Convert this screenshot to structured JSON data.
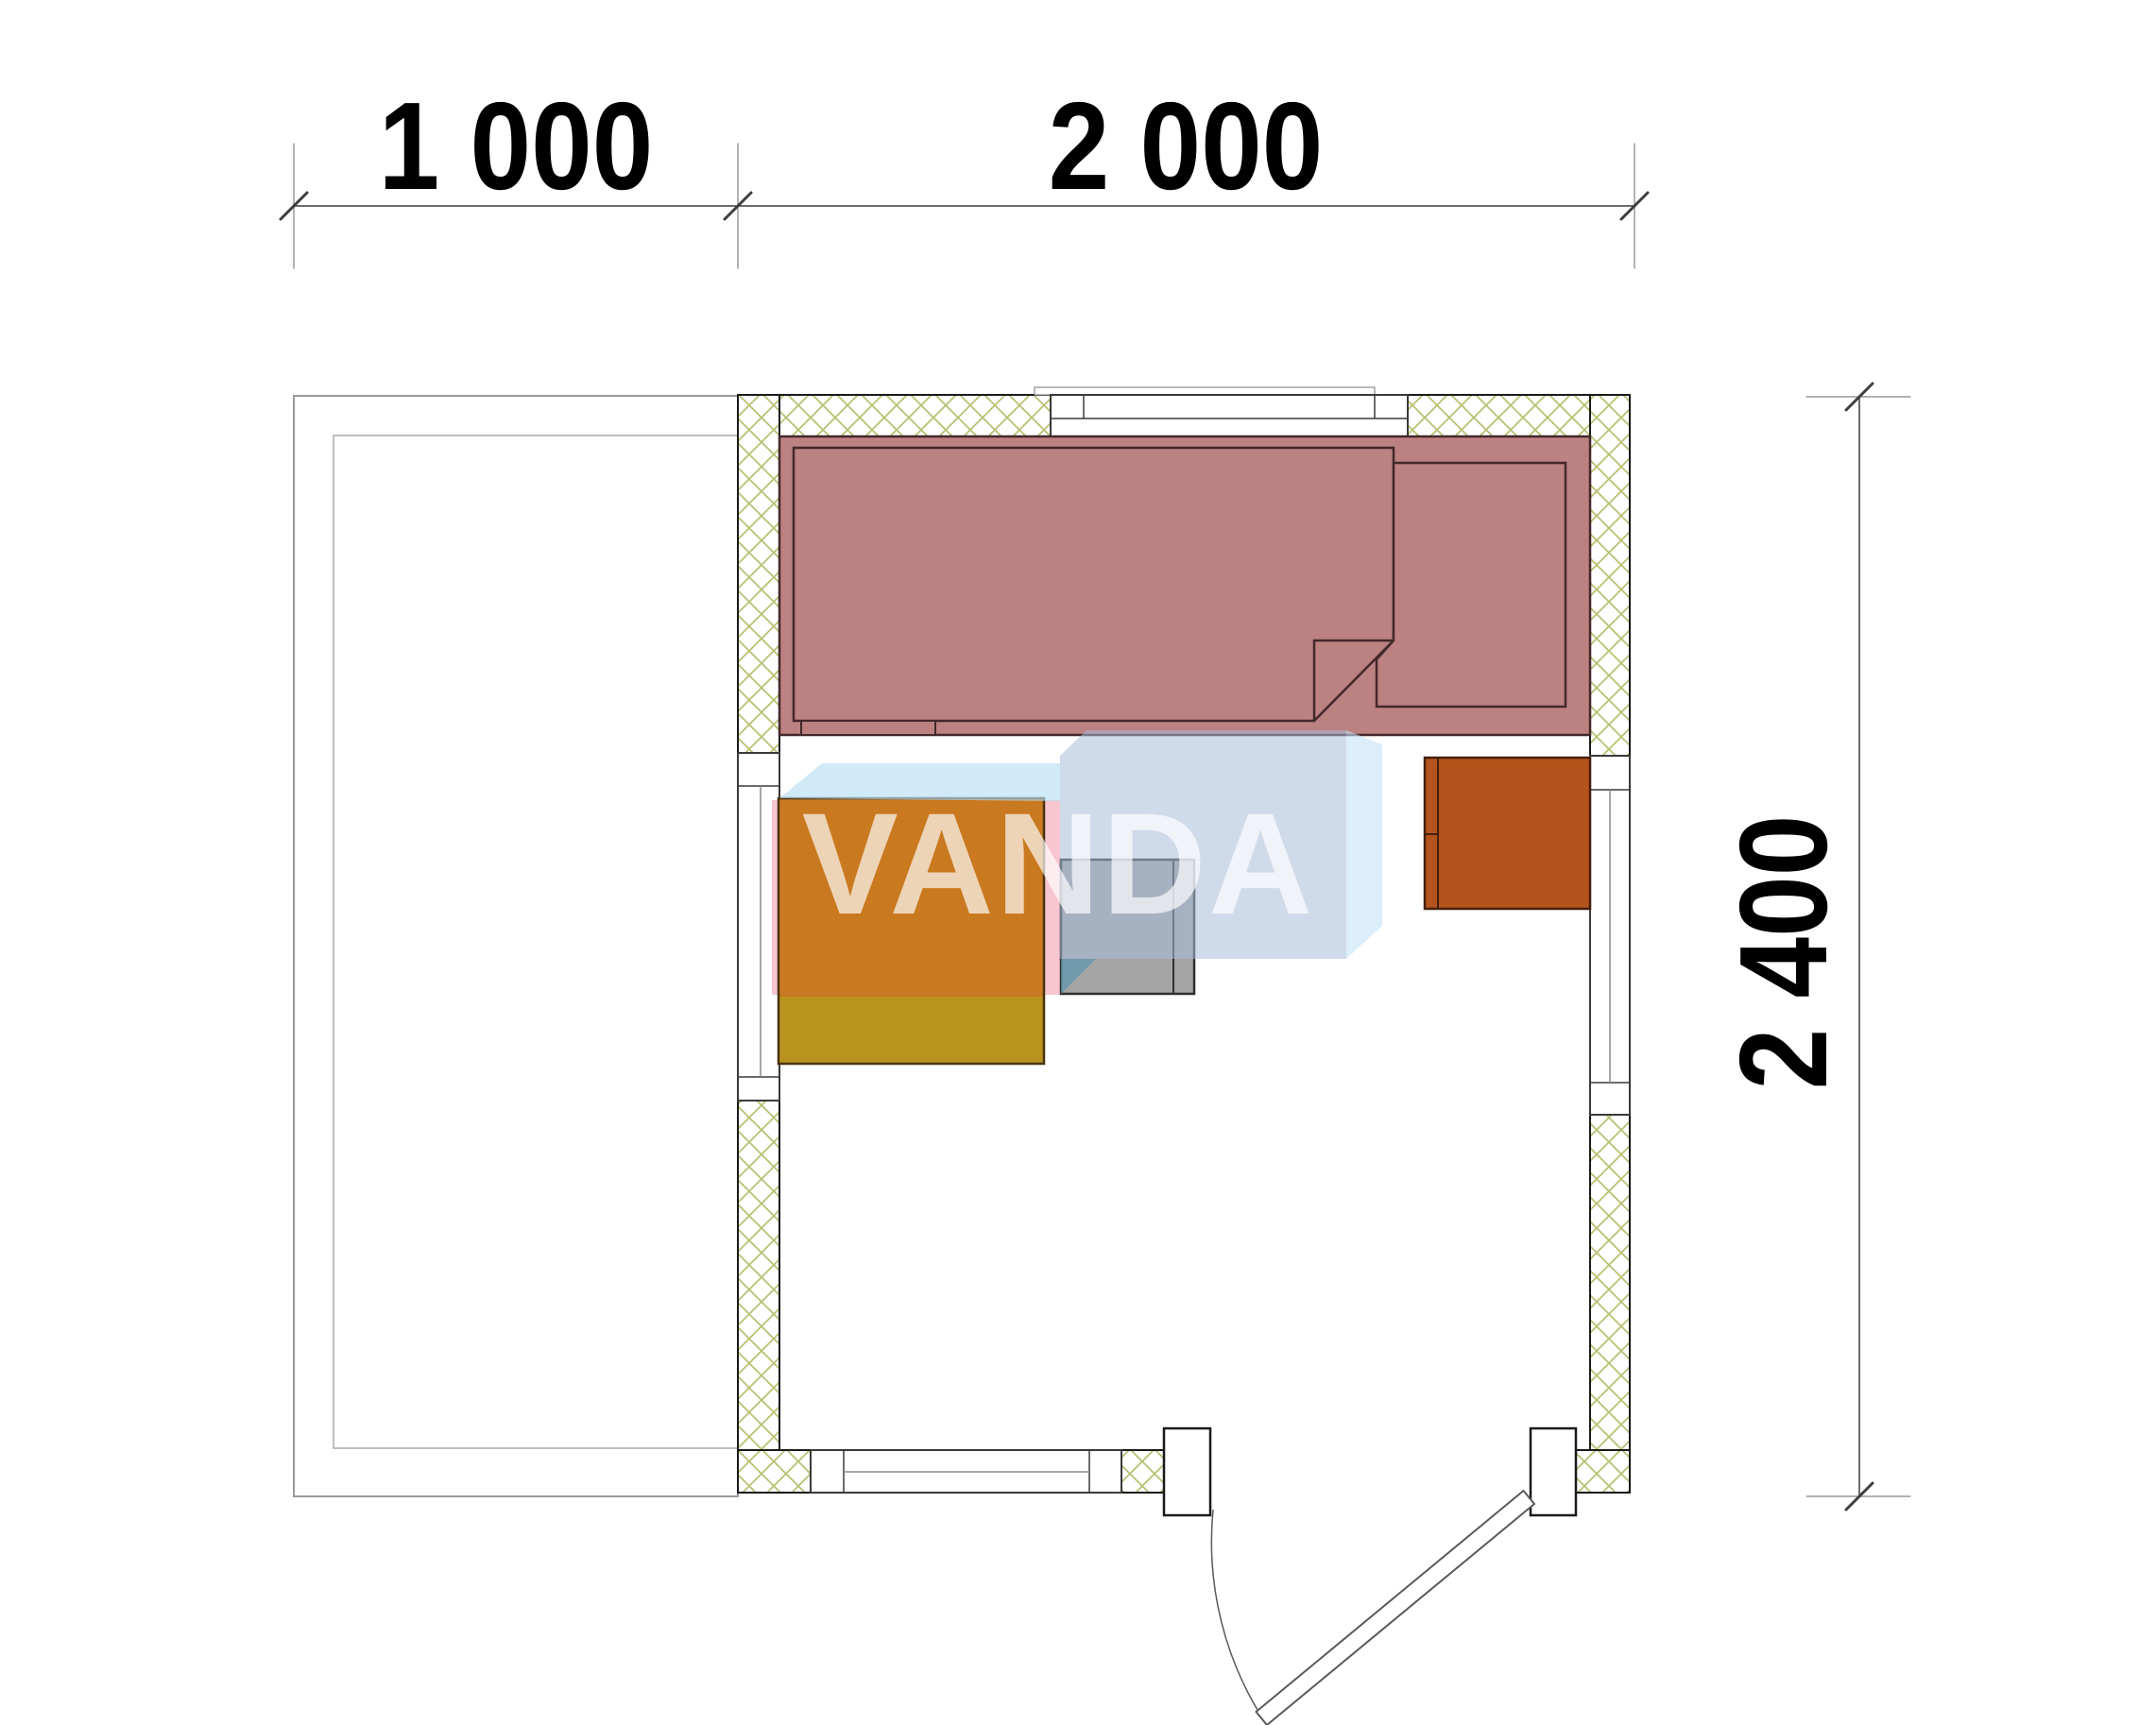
{
  "dimensions": {
    "top_segment_left": "1 000",
    "top_segment_right": "2 000",
    "right_side": "2 400"
  },
  "watermark": {
    "text": "VANDA"
  },
  "colors": {
    "wall_line": "#1a1a1a",
    "hatch": "#b9c173",
    "dim_line": "#3d3d3d",
    "extension_line": "#808080",
    "terrace_line": "#9a9a9a",
    "bench_fill": "#bc8181",
    "bench_line": "#42292b",
    "heater_orange": "#c9791f",
    "heater_olive": "#b8941f",
    "heater_line": "#4a3210",
    "stove_gray": "#a5a5a5",
    "stove_line": "#2e2e2e",
    "cabinet_fill": "#b4531b",
    "cabinet_line": "#471f08",
    "window_line": "#3a3a3a",
    "glass_line": "#8a8a8a",
    "door_line": "#5a5a5a",
    "wm_top_face": "#b8dff5",
    "wm_front_face": "#a8bcd8",
    "wm_right_face": "#c4e2f6",
    "wm_teal": "#5f95ad",
    "wm_pink": "#f2a0b0",
    "wm_text": "#ffffff"
  }
}
